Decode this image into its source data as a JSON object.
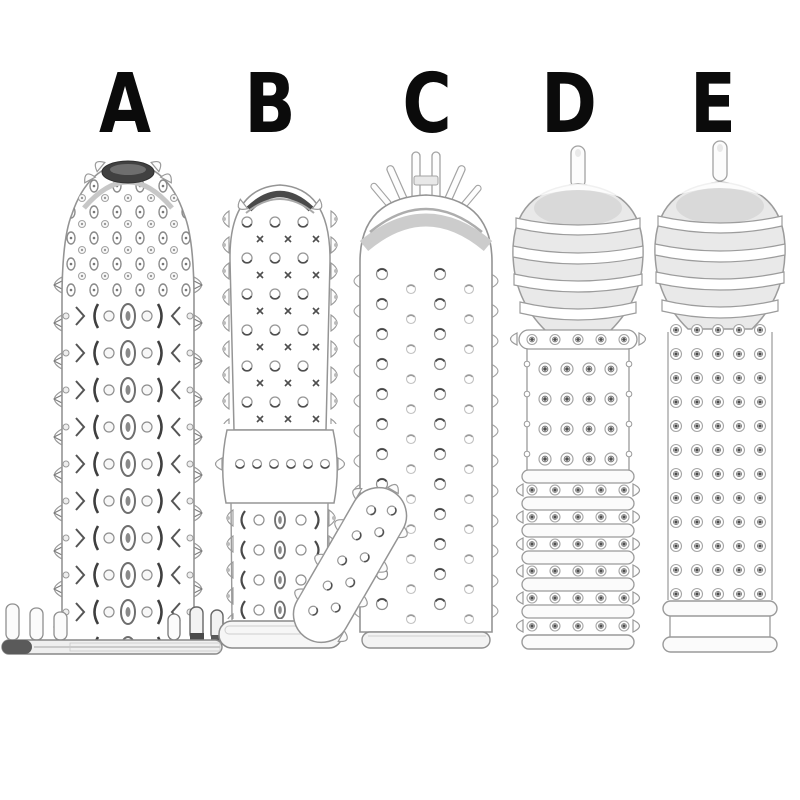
{
  "image_type": "product-variant-photo",
  "background": "#ffffff",
  "products": [
    {
      "label": "A",
      "illustration": "dark-tip-studded-textured-sleeve-with-winged-flat-base"
    },
    {
      "label": "B",
      "illustration": "dark-rim-nubbed-sleeve-with-smooth-mid-band-and-angled-finger-nub-attachment"
    },
    {
      "label": "C",
      "illustration": "tendril-tip-smooth-head-dotted-sleeve-with-side-spikes"
    },
    {
      "label": "D",
      "illustration": "teardrop-tip-ribbed-dome-sleeve-with-stud-rows-and-ring-segments"
    },
    {
      "label": "E",
      "illustration": "teardrop-tip-ribbed-dome-sleeve-with-dense-stud-shaft-and-double-ring-base"
    }
  ],
  "colors": {
    "label_text": "#0b0b0b",
    "outline": "#9a9a9a",
    "dark_accent": "#3d3d3d",
    "shading": "#e9e9e9",
    "background": "#ffffff"
  }
}
